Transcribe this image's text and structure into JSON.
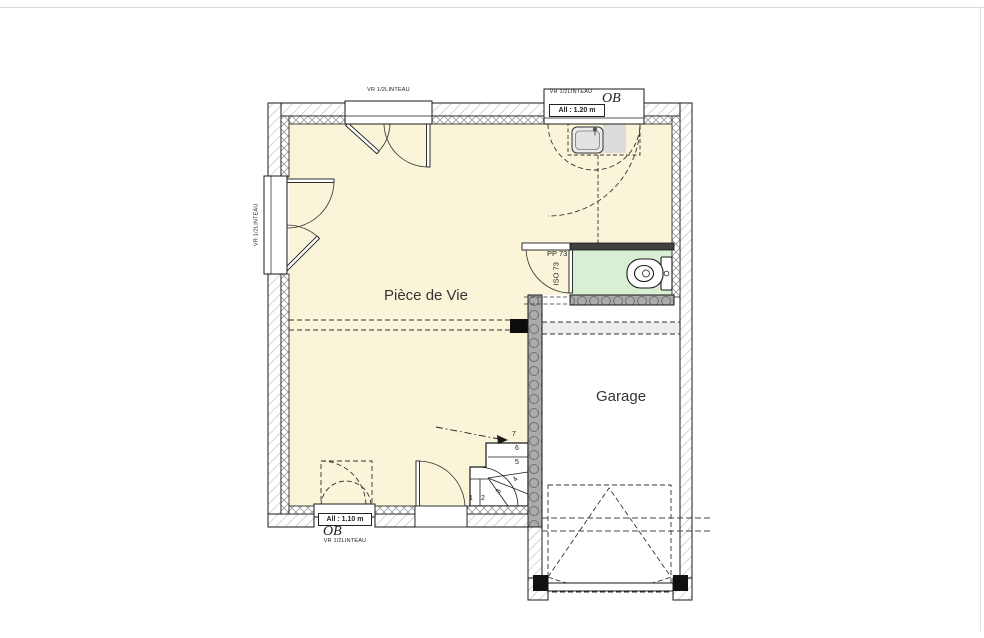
{
  "plan": {
    "rooms": {
      "living": {
        "label": "Pièce de Vie"
      },
      "garage": {
        "label": "Garage"
      }
    },
    "windows": {
      "top_left": {
        "shutter": "VR 1/2LINTEAU"
      },
      "top_right": {
        "shutter": "VR 1/2LINTEAU",
        "opening_type": "OB",
        "sill": "All : 1.20 m"
      },
      "left": {
        "shutter": "VR 1/2LINTEAU"
      },
      "bottom": {
        "shutter": "VR 1/2LINTEAU",
        "opening_type": "OB",
        "sill": "All : 1.10 m"
      }
    },
    "wc_door": {
      "label": "PP 73",
      "iso_label": "ISO 73"
    },
    "stairs": {
      "steps": [
        "1",
        "2",
        "3",
        "4",
        "5",
        "6",
        "7"
      ]
    },
    "colors": {
      "floor": "#FAF5D8",
      "wc_floor": "#D9EFD3",
      "garage_floor": "#FFFFFF",
      "separating_wall": "#ABABAB",
      "partition_dark": "#404040",
      "outline": "#1A1A1A"
    }
  }
}
